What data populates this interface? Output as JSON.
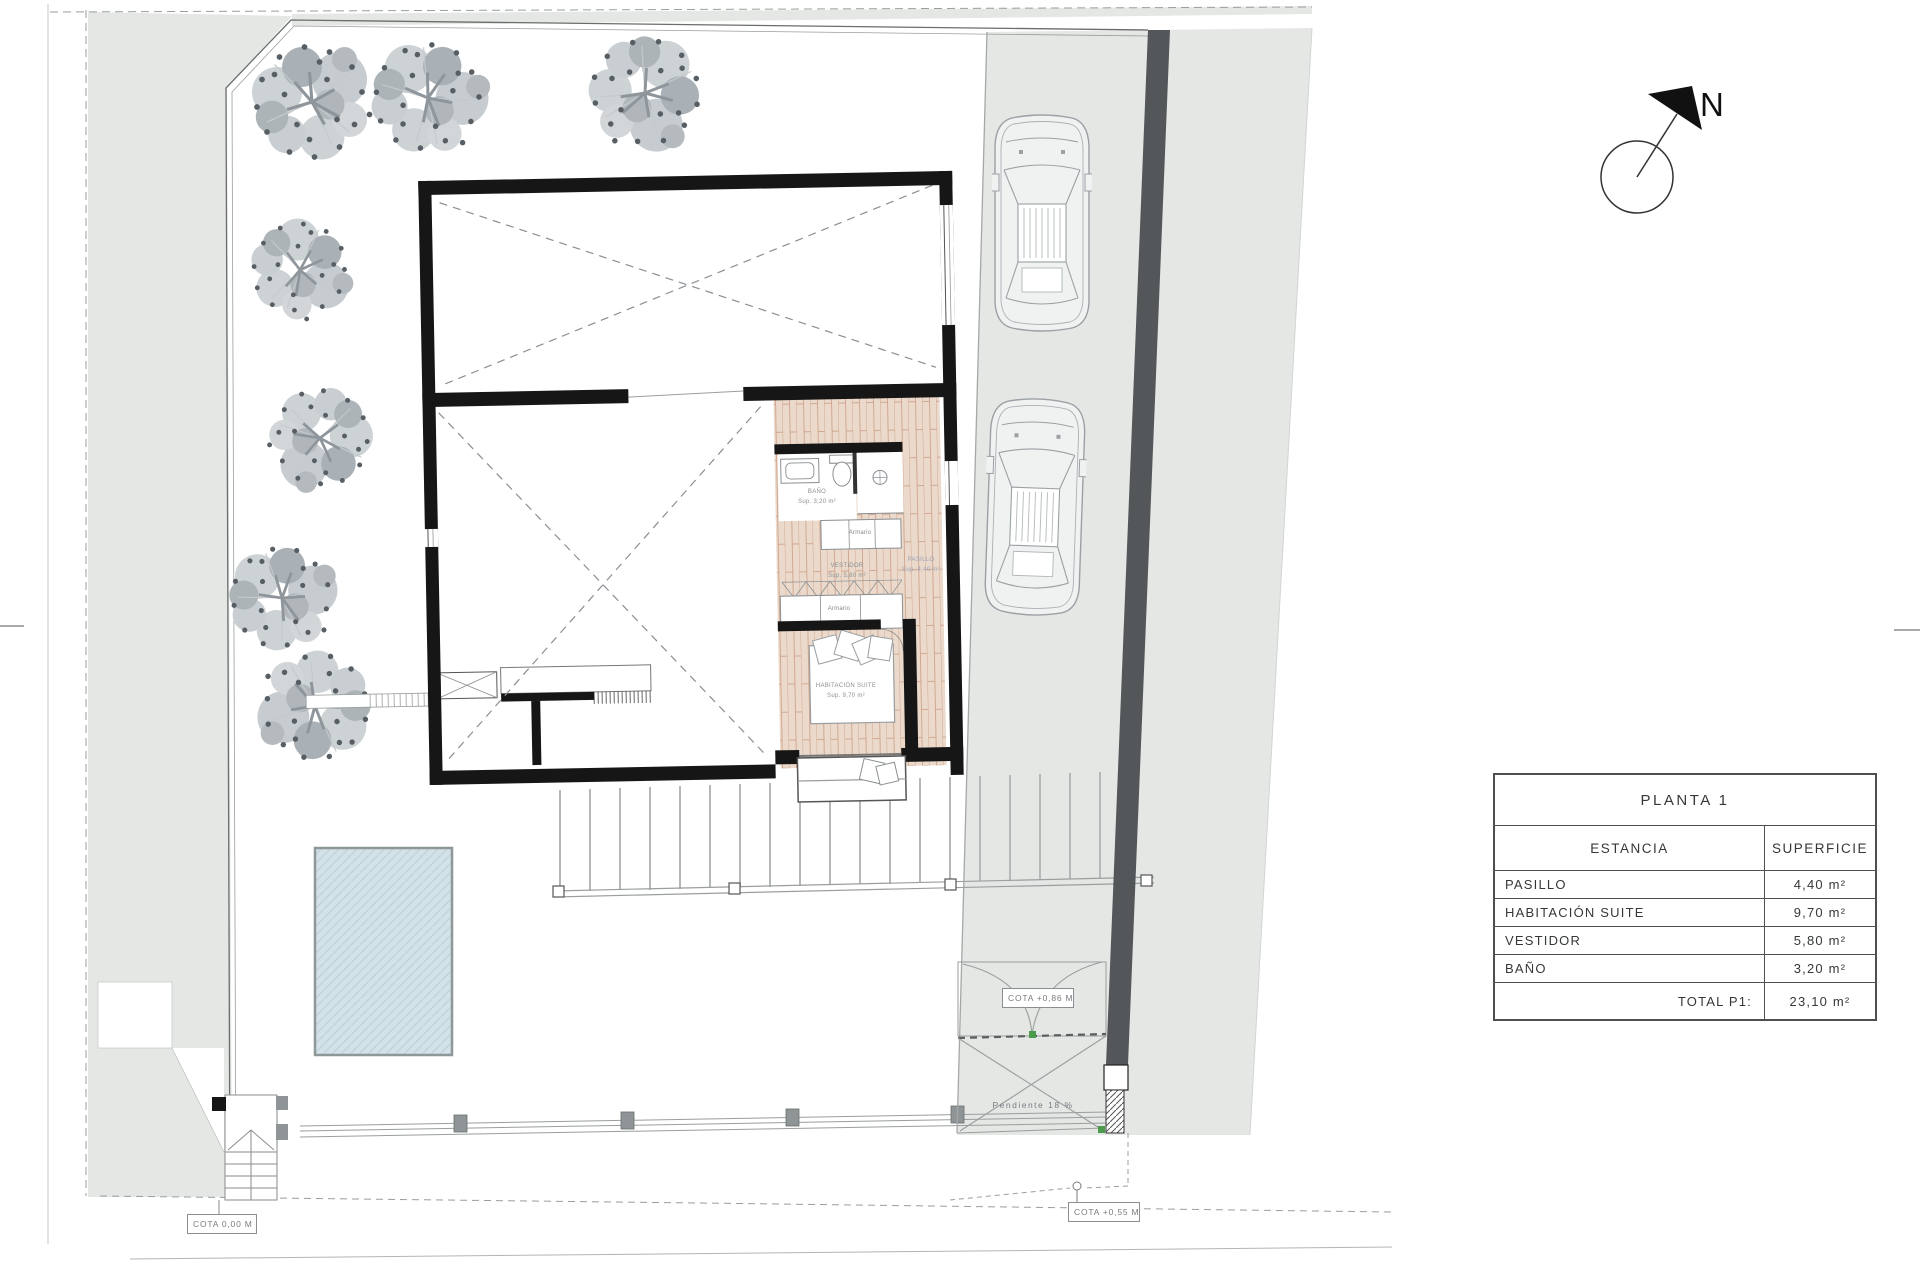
{
  "surface_table": {
    "title": "PLANTA 1",
    "col_room": "ESTANCIA",
    "col_area": "SUPERFICIE",
    "rows": [
      {
        "label": "PASILLO",
        "area": "4,40 m²"
      },
      {
        "label": "HABITACIÓN SUITE",
        "area": "9,70 m²"
      },
      {
        "label": "VESTIDOR",
        "area": "5,80 m²"
      },
      {
        "label": "BAÑO",
        "area": "3,20 m²"
      }
    ],
    "total_label": "TOTAL P1:",
    "total_area": "23,10 m²"
  },
  "annotations": {
    "cota_ground": "COTA 0,00 M",
    "cota_street": "COTA +0,55 M",
    "cota_gate": "COTA +0,86 M",
    "slope": "Pendiente 18 %",
    "north": "N"
  },
  "rooms": {
    "bathroom": "BAÑO\nSup. 3,20 m²",
    "suite": "HABITACIÓN SUITE\nSup. 9,70 m²",
    "vestidor": "VESTIDOR\nSup. 5,80 m²",
    "hallway": "PASILLO\nSup. 4,40 m²",
    "wardrobe_top": "Armario",
    "wardrobe_bottom": "Armario"
  },
  "colors": {
    "site_gray": "#e4e7e4",
    "wall_black": "#161616",
    "retaining_wall": "#54575a",
    "wood_floor": "#ebdacb",
    "pool_water": "#d3e1e8",
    "tree_gray": "#b6bcc0",
    "accent_green": "#4a9b4a"
  }
}
